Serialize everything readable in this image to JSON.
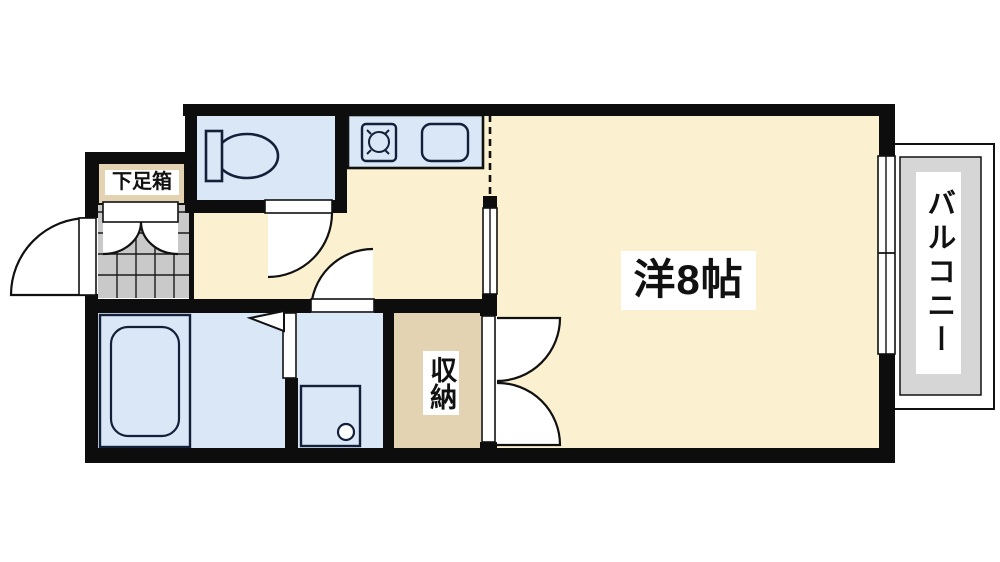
{
  "labels": {
    "shoe_box": "下足箱",
    "main_room": "洋8帖",
    "storage": "収納",
    "balcony": "バルコニー"
  },
  "colors": {
    "floor": "#FBF0D0",
    "wet_area": "#DAE7F6",
    "storage_tan": "#E3D3B2",
    "tile_gray": "#C9C9C9",
    "balcony_gray": "#D6D6D6",
    "wall": "#0D0D0D",
    "label_bg": "#FFFFFF"
  },
  "icons": {
    "toilet": "toilet-icon",
    "stove": "stove-burner-icon",
    "sink": "kitchen-sink-icon",
    "bathtub": "bathtub-icon",
    "washer_pan": "washing-machine-pan-icon",
    "entrance_door": "entrance-door-swing-icon",
    "window": "sliding-window-icon"
  }
}
